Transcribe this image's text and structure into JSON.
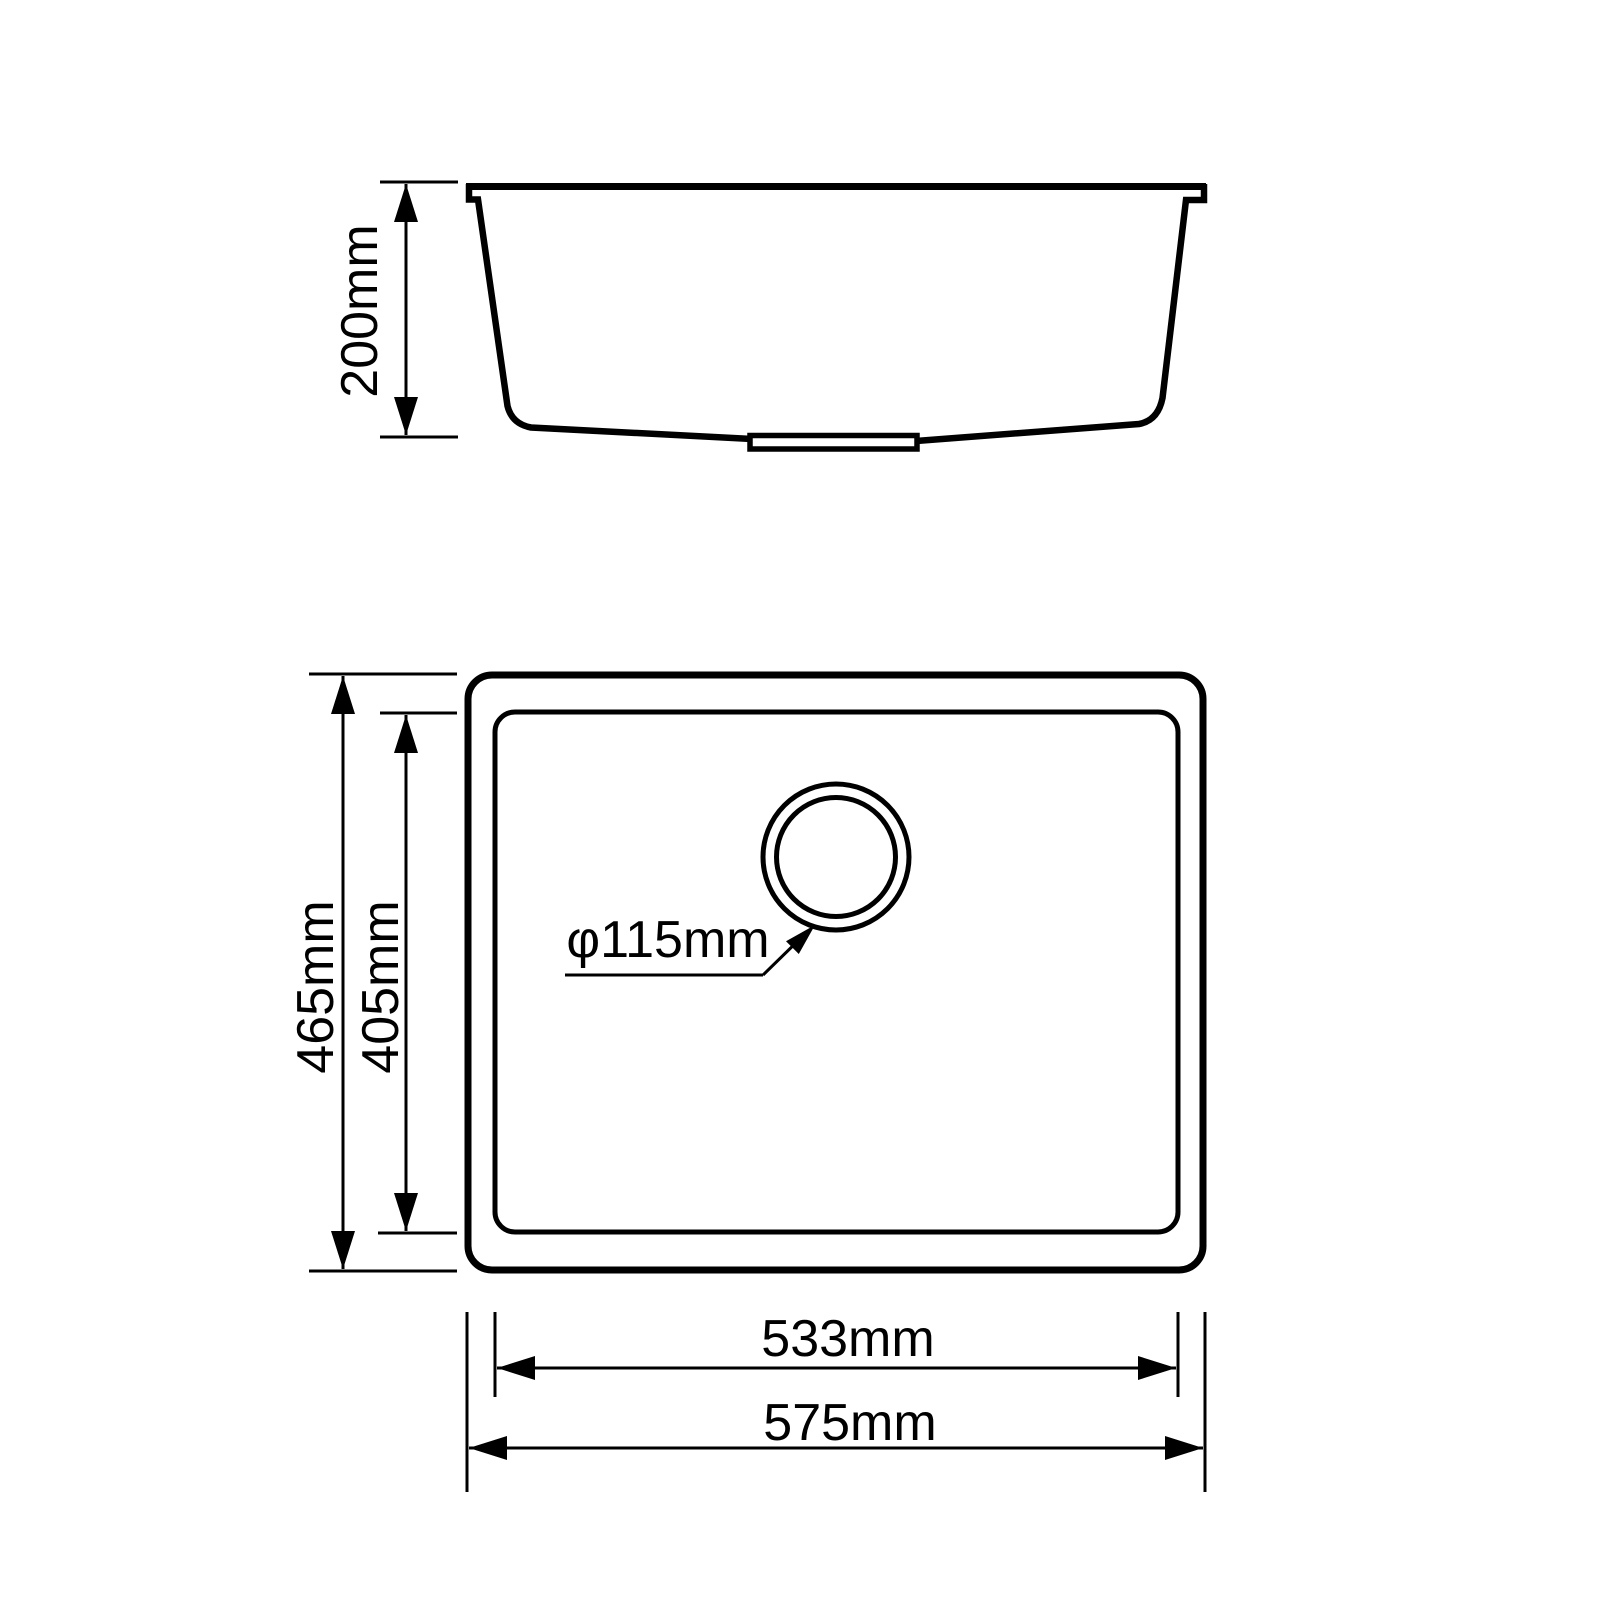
{
  "page": {
    "background_color": "#ffffff",
    "line_color": "#000000"
  },
  "diagram": {
    "type": "technical-drawing",
    "subject": "kitchen sink dimension drawing, side section view above top plan view",
    "side_view": {
      "depth_label": "200mm"
    },
    "top_view": {
      "overall_height_label": "465mm",
      "bowl_height_label": "405mm",
      "drain_label": "φ115mm",
      "bowl_width_label": "533mm",
      "overall_width_label": "575mm"
    }
  }
}
